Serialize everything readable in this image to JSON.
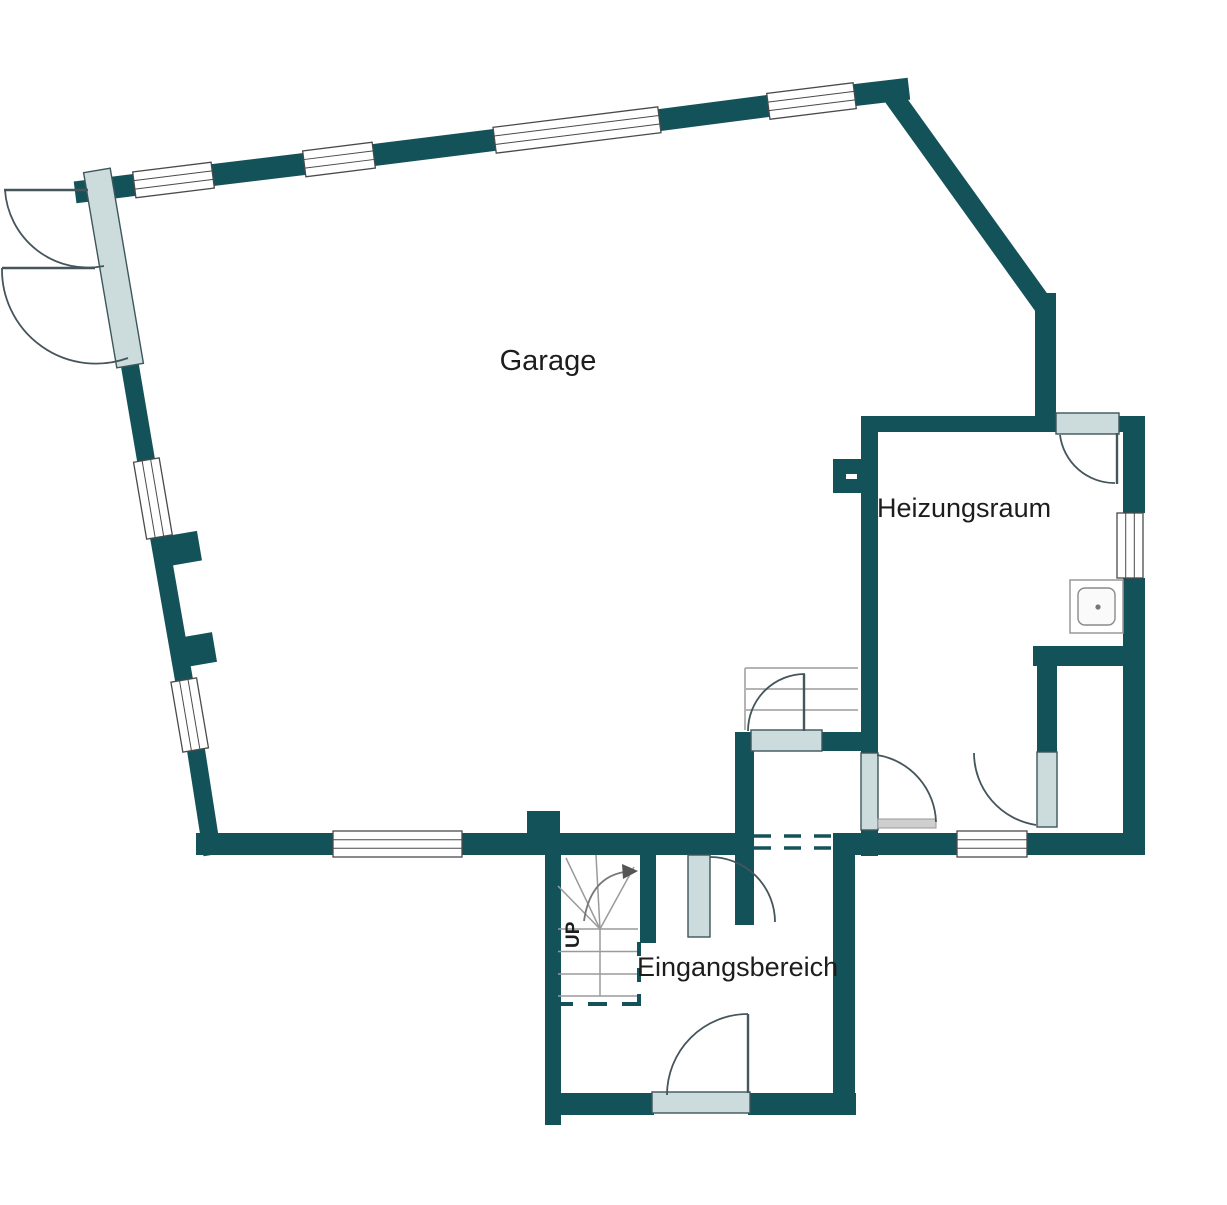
{
  "plan": {
    "type": "floor-plan",
    "labels": {
      "garage": "Garage",
      "heating_room": "Heizungsraum",
      "entrance_area": "Eingangsbereich",
      "stairs_up": "UP"
    },
    "rooms": [
      {
        "label": "Garage"
      },
      {
        "label": "Heizungsraum"
      },
      {
        "label": "Eingangsbereich"
      }
    ]
  },
  "colors": {
    "wall": "#14525a",
    "door_leaf": "#ccdcdc",
    "leaf_stroke": "#3d565c",
    "window_line": "#4a4a4a",
    "swing_arc": "#44555c",
    "stair_line": "#9a9a9a",
    "step_line": "#b4b4b4",
    "text": "#1d1d1d",
    "background": "#ffffff"
  }
}
